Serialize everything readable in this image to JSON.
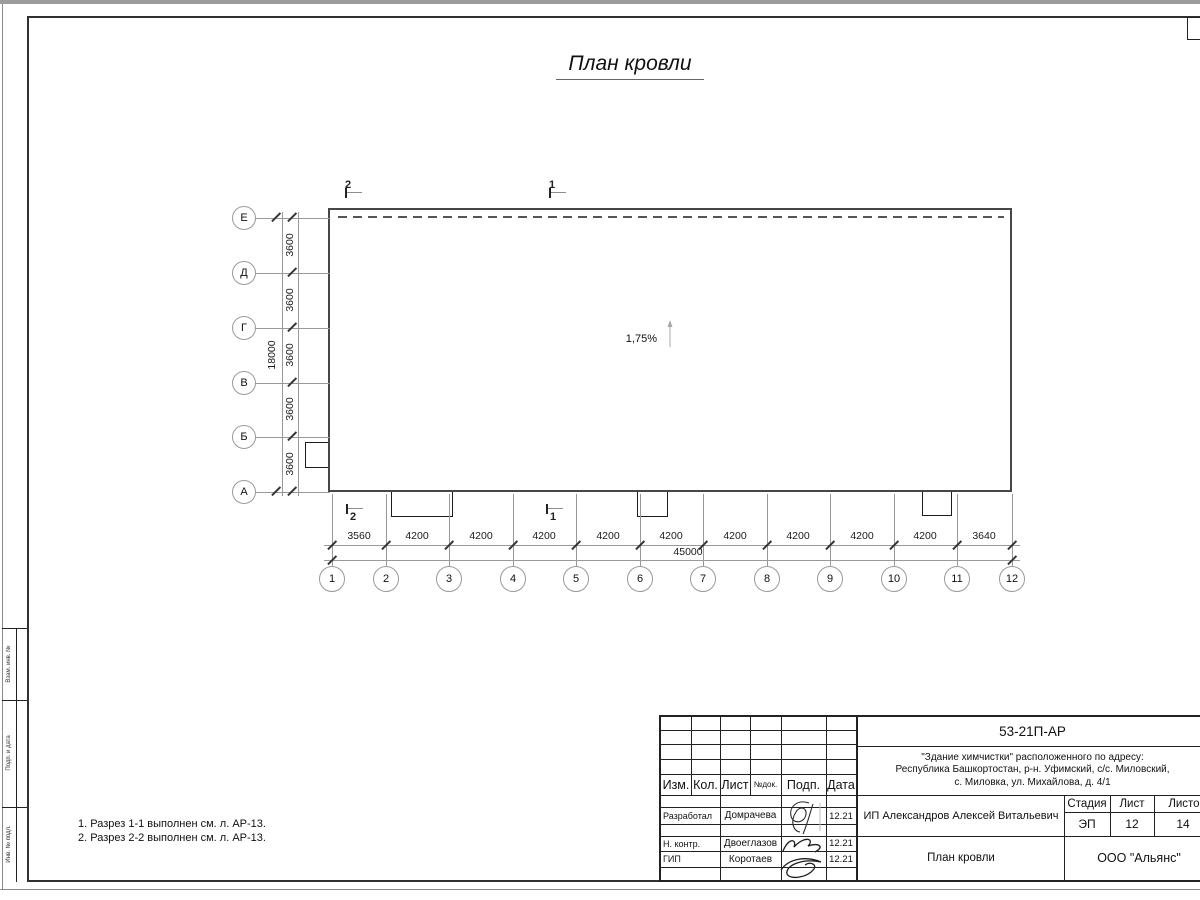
{
  "title": "План кровли",
  "slope": {
    "label": "1,75%"
  },
  "axes": {
    "rows": [
      "Е",
      "Д",
      "Г",
      "В",
      "Б",
      "А"
    ],
    "row_dims": [
      "3600",
      "3600",
      "3600",
      "3600",
      "3600"
    ],
    "row_total": "18000",
    "cols": [
      "1",
      "2",
      "3",
      "4",
      "5",
      "6",
      "7",
      "8",
      "9",
      "10",
      "11",
      "12"
    ],
    "col_dims": [
      "3560",
      "4200",
      "4200",
      "4200",
      "4200",
      "4200",
      "4200",
      "4200",
      "4200",
      "4200",
      "3640"
    ],
    "col_total": "45000"
  },
  "sections": {
    "top_left": "2",
    "top_right": "1",
    "bottom_left": "2",
    "bottom_right": "1"
  },
  "notes": [
    "1. Разрез 1-1 выполнен см. л. АР-13.",
    "2. Разрез 2-2 выполнен см. л. АР-13."
  ],
  "side_strip": [
    "Взам. инв. №",
    "Подп. и дата",
    "Инв. № подл."
  ],
  "stamp": {
    "doc_number": "53-21П-АР",
    "address_line1": "\"Здание химчистки\" расположенного по адресу:",
    "address_line2": "Республика Башкортостан, р-н. Уфимский, с/с. Миловский,",
    "address_line3": "с. Миловка, ул. Михайлова, д. 4/1",
    "cols": {
      "izm": "Изм.",
      "kol": "Кол.",
      "list": "Лист",
      "ndok": "№док.",
      "podp": "Подп.",
      "data": "Дата"
    },
    "roles": [
      {
        "role": "Разработал",
        "name": "Домрачева",
        "date": "12.21"
      },
      {
        "role": "Н. контр.",
        "name": "Двоеглазов",
        "date": "12.21"
      },
      {
        "role": "ГИП",
        "name": "Коротаев",
        "date": "12.21"
      }
    ],
    "client": "ИП Александров Алексей Витальевич",
    "stage_label": "Стадия",
    "sheet_label": "Лист",
    "sheets_label": "Листов",
    "stage": "ЭП",
    "sheet": "12",
    "sheets": "14",
    "sheet_title": "План кровли",
    "company": "ООО \"Альянс\""
  }
}
